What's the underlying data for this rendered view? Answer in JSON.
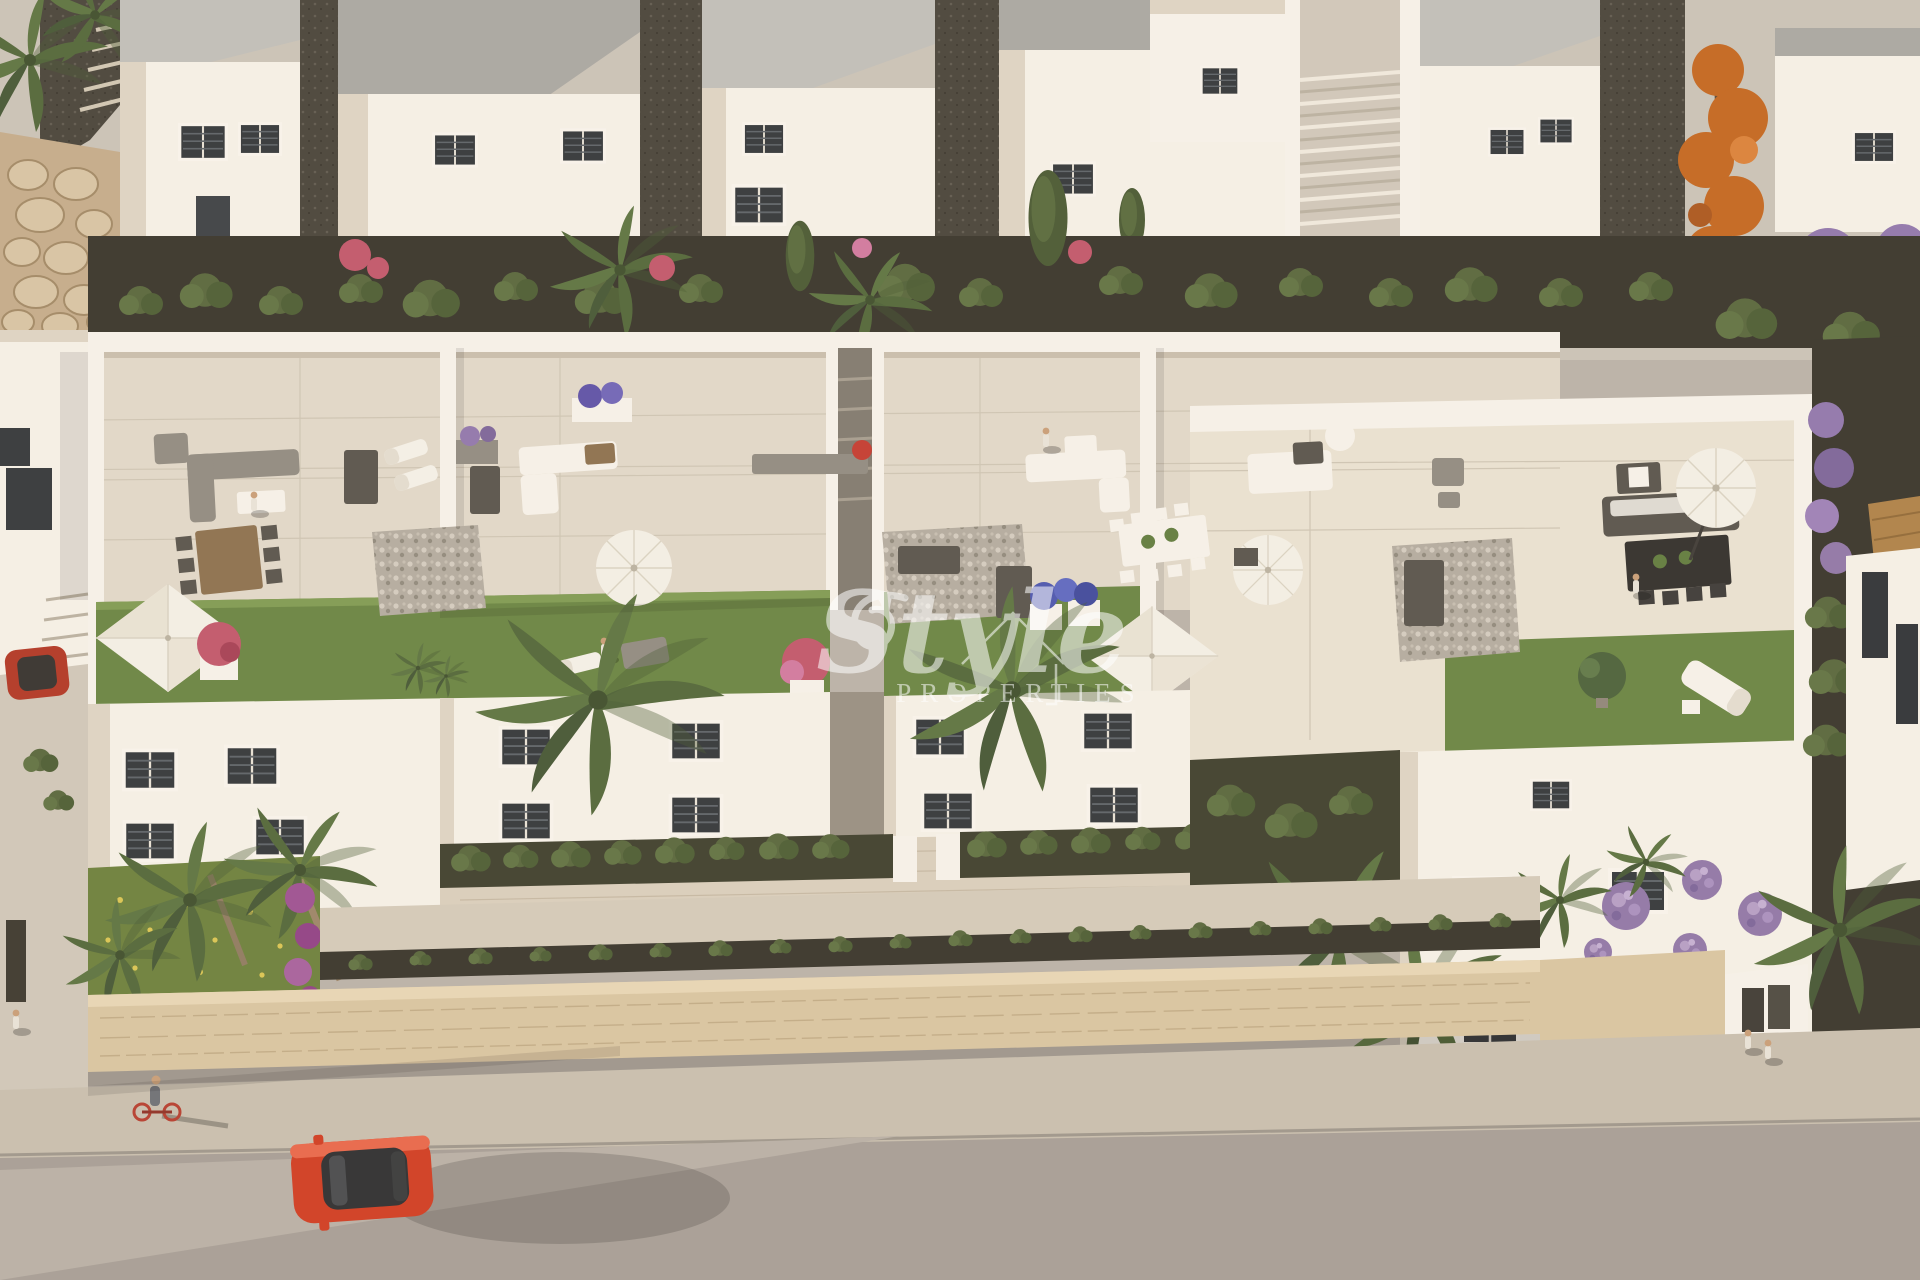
{
  "watermark": {
    "brand_script": "Style",
    "brand_caps": "PROPERTIES",
    "icon": "house-outline-icon",
    "color": "#ffffff",
    "opacity": 0.55
  },
  "palette": {
    "back_ground": "#c9c3b9",
    "soil_dark": "#35332b",
    "building_white": "#f5f1e9",
    "roof_gray": "#a4a4a0",
    "terrace_floor": "#e0d9cb",
    "terrace_floor_warm": "#e9e2d3",
    "lawn_green": "#678442",
    "garden_grass": "#6a7f3c",
    "hedge_green": "#52633a",
    "stone_wall": "#d8c5a2",
    "sidewalk": "#c7bfb0",
    "road": "#a59e97",
    "road_light": "#b7b0a7",
    "car_red": "#cf3b21",
    "orange_tree": "#c2661f",
    "flower_purple": "#8e76ae",
    "flower_red": "#c0556b",
    "parasol_white": "#f3f0e8"
  }
}
